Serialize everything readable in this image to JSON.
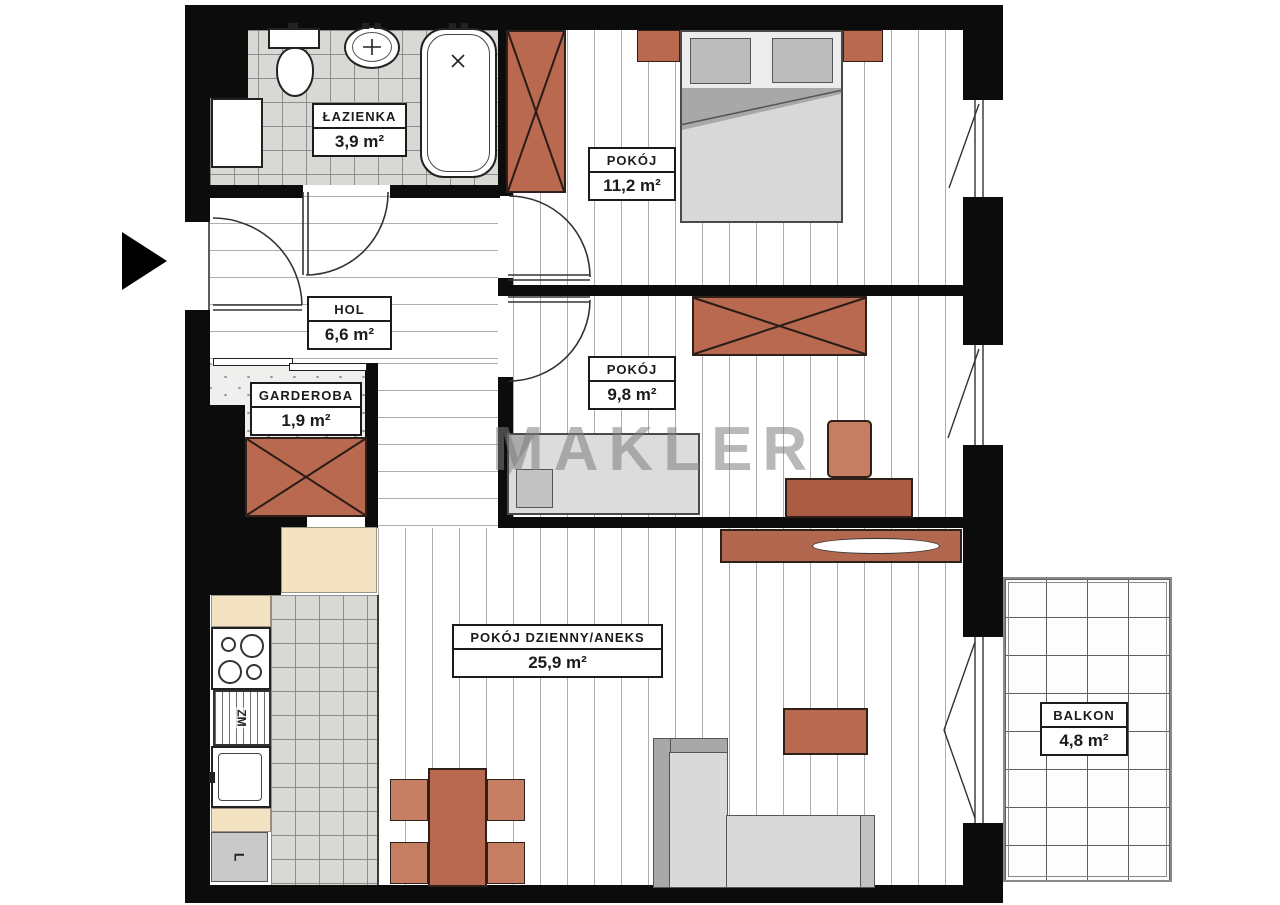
{
  "watermark": "MAKLER",
  "rooms": {
    "bathroom": {
      "name": "ŁAZIENKA",
      "area": "3,9 m²"
    },
    "bedroom1": {
      "name": "POKÓJ",
      "area": "11,2 m²"
    },
    "hall": {
      "name": "HOL",
      "area": "6,6 m²"
    },
    "wardrobe_room": {
      "name": "GARDEROBA",
      "area": "1,9 m²"
    },
    "bedroom2": {
      "name": "POKÓJ",
      "area": "9,8 m²"
    },
    "living": {
      "name": "POKÓJ DZIENNY/ANEKS",
      "area": "25,9 m²"
    },
    "balcony": {
      "name": "BALKON",
      "area": "4,8 m²"
    }
  },
  "appliances": {
    "dishwasher_label": "ZM",
    "fridge_label": "L"
  },
  "colors": {
    "wall": "#0c0c0c",
    "furniture_accent": "#b9694f",
    "counter_beige": "#f4e3c2",
    "tile_gray": "#d8d8d5",
    "watermark_gray": "#7d7d7d"
  }
}
